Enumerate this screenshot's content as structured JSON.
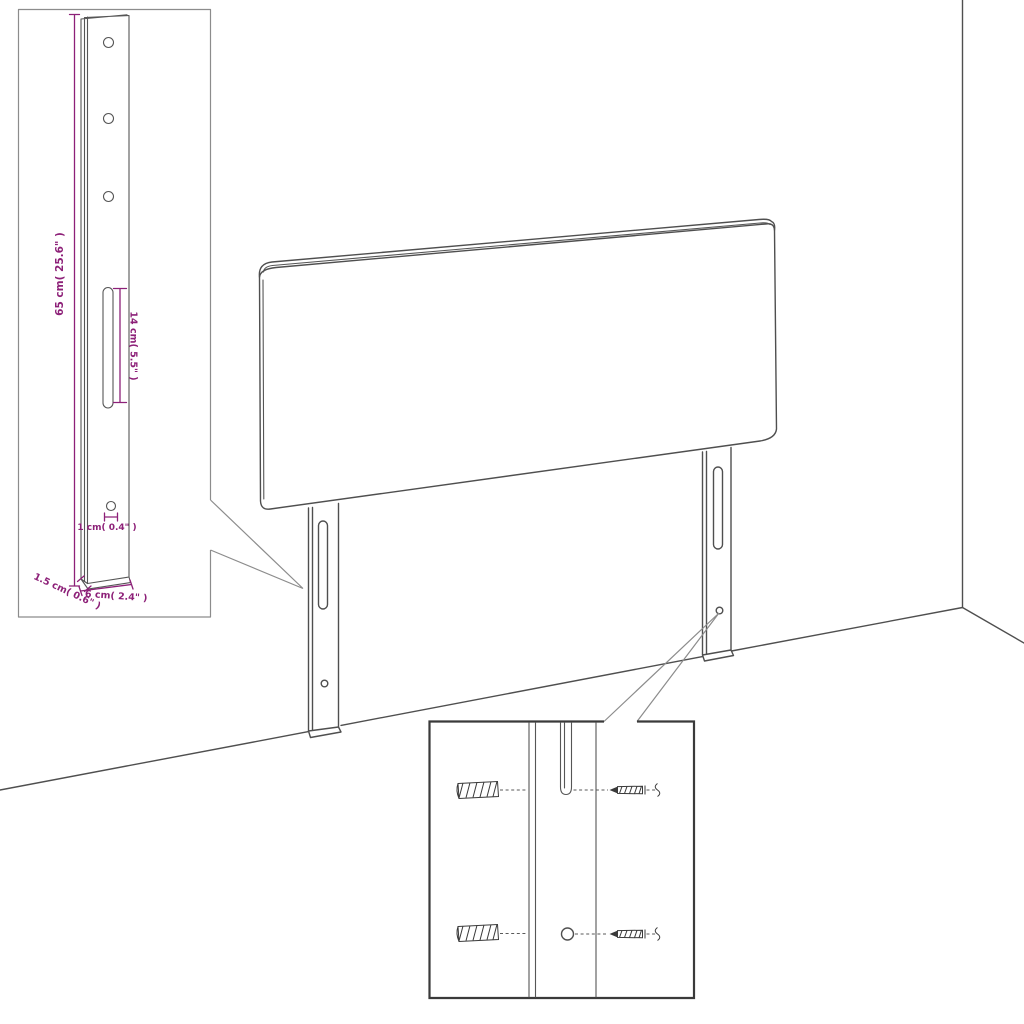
{
  "diagram": {
    "title": "headboard-assembly-dimension-diagram",
    "colors": {
      "line": "#4f4f4f",
      "dimension_accent": "#8d2078",
      "callout": "#8c8c8c",
      "inset_border_light": "#8c8c8c",
      "inset_border_dark": "#3a3a3a",
      "background": "#ffffff"
    },
    "leg_detail_inset": {
      "height_label": "65 cm( 25.6\" )",
      "slot_length_label": "14 cm( 5.5\" )",
      "hole_diameter_label": "1 cm( 0.4\" )",
      "thickness_label": "1.5 cm( 0.6\" )",
      "width_label": "6 cm( 2.4\" )"
    },
    "mounting_inset": {
      "wall_plug_count": 2,
      "screw_count": 2
    }
  }
}
